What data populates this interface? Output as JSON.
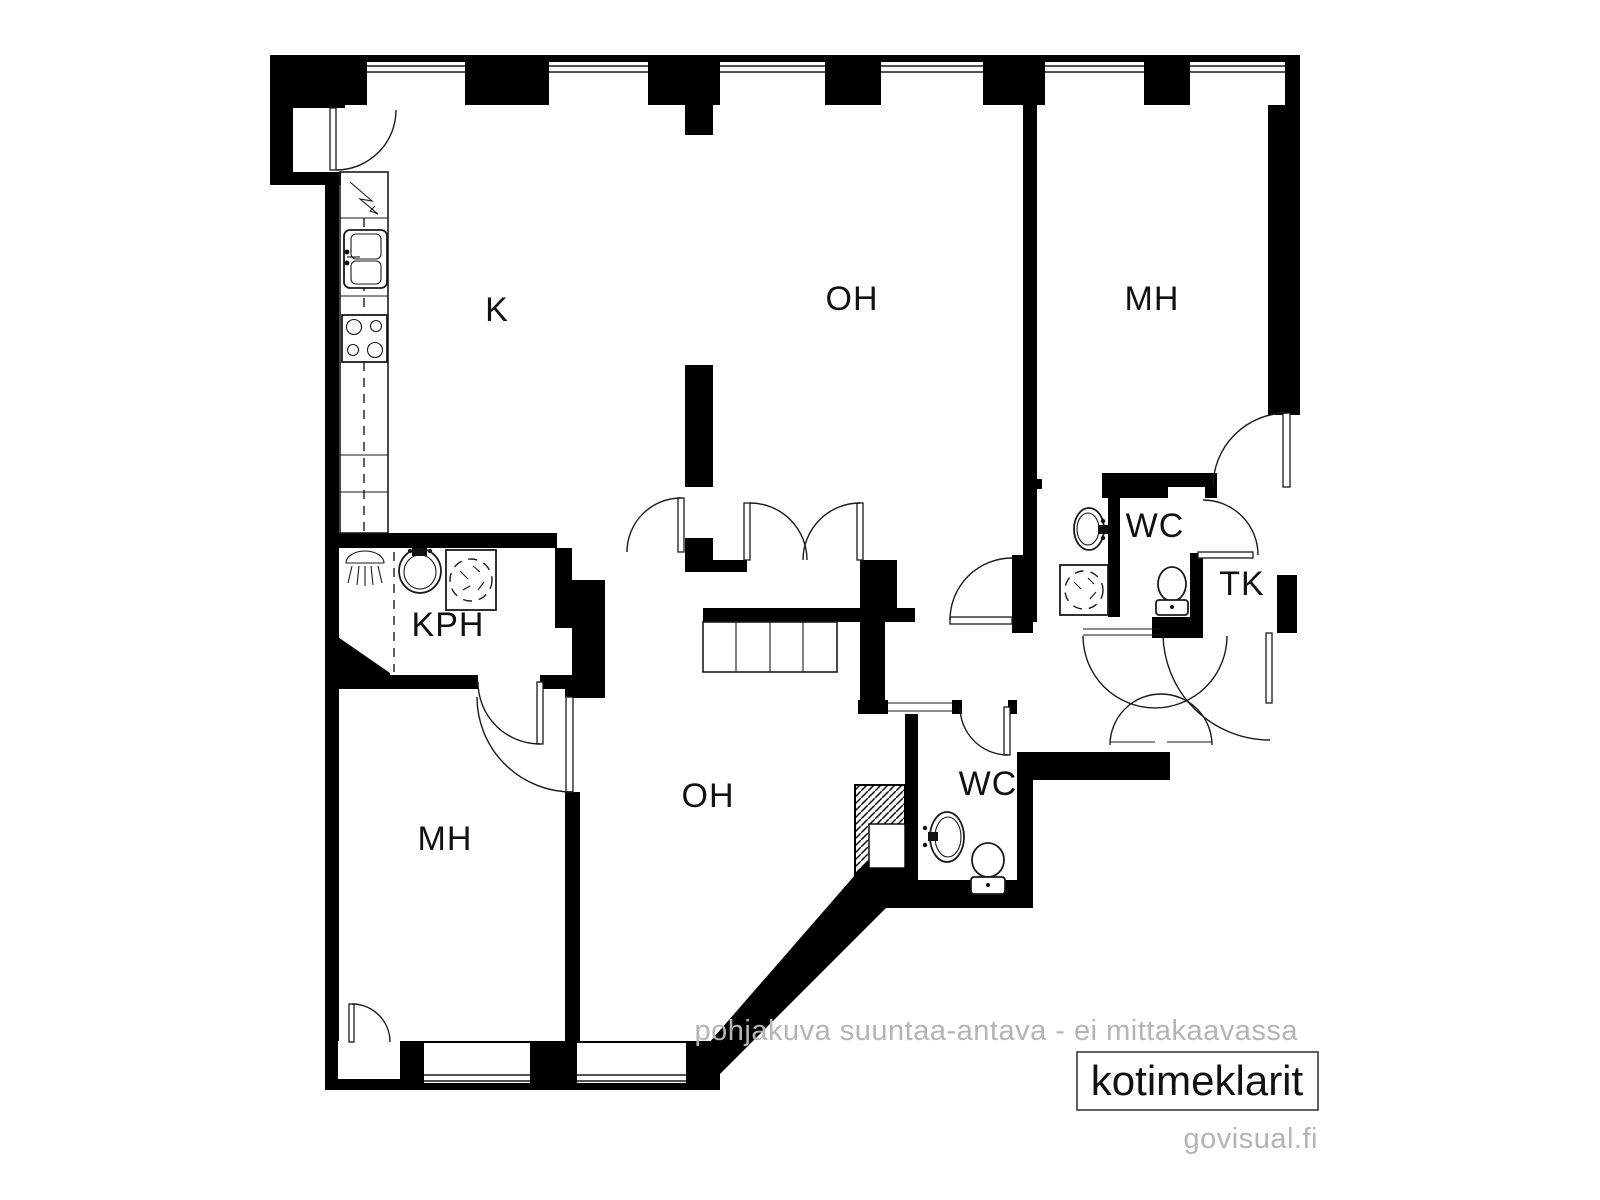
{
  "plan": {
    "type": "apartment-floor-plan",
    "rooms": [
      {
        "id": "kitchen",
        "label": "K"
      },
      {
        "id": "living-room-top",
        "label": "OH"
      },
      {
        "id": "bedroom-top-right",
        "label": "MH"
      },
      {
        "id": "bathroom",
        "label": "KPH"
      },
      {
        "id": "wc-top",
        "label": "WC"
      },
      {
        "id": "entry-vestibule",
        "label": "TK"
      },
      {
        "id": "bedroom-bottom-left",
        "label": "MH"
      },
      {
        "id": "living-room-bottom",
        "label": "OH"
      },
      {
        "id": "wc-bottom",
        "label": "WC"
      }
    ],
    "fixtures": [
      "electrical-panel-icon",
      "kitchen-double-sink-icon",
      "stove-icon",
      "shower-icon",
      "washbasin-icon",
      "washing-machine-icon",
      "toilet-icon",
      "duct-shaft-hatch",
      "window",
      "door-swing-arc",
      "wardrobe-closet"
    ]
  },
  "footer": {
    "disclaimer": "pohjakuva suuntaa-antava - ei mittakaavassa",
    "brand": "kotimeklarit",
    "website": "govisual.fi"
  },
  "colors": {
    "wall": "#000000",
    "background": "#ffffff",
    "line": "#1a1a1a",
    "muted_text": "#b4b4b4"
  }
}
